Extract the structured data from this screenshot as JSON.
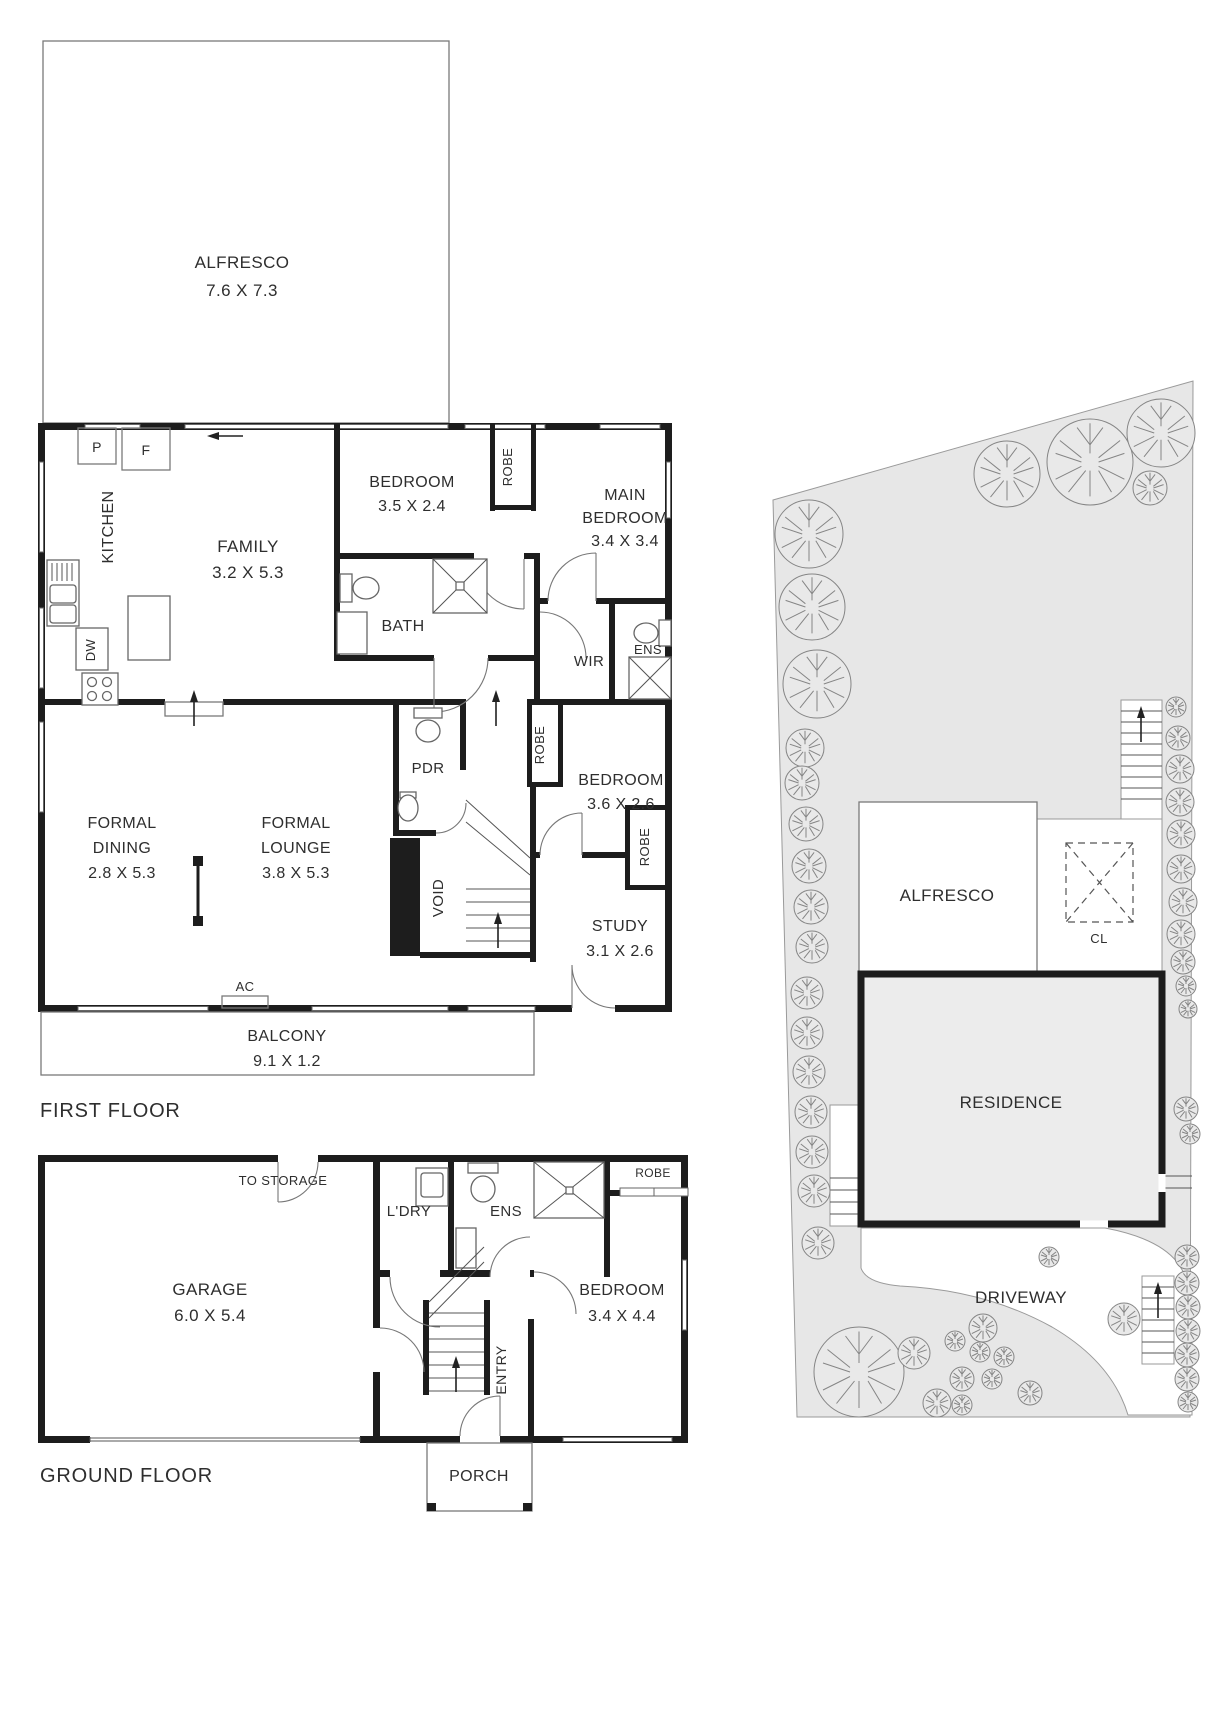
{
  "first_floor": {
    "section_label": "FIRST FLOOR",
    "alfresco": {
      "name": "ALFRESCO",
      "dims": "7.6 X 7.3"
    },
    "kitchen": {
      "name": "KITCHEN",
      "pantry_abbr": "P",
      "fridge_abbr": "F",
      "dishwasher_abbr": "DW"
    },
    "family": {
      "name": "FAMILY",
      "dims": "3.2 X 5.3"
    },
    "bedroom_2": {
      "name": "BEDROOM",
      "dims": "3.5 X 2.4"
    },
    "robe_bedroom_2": "ROBE",
    "main_bedroom": {
      "line1": "MAIN",
      "line2": "BEDROOM",
      "dims": "3.4 X 3.4"
    },
    "bath": "BATH",
    "wir": "WIR",
    "ens": "ENS",
    "pdr": "PDR",
    "bedroom_3": {
      "name": "BEDROOM",
      "dims": "3.6 X 2.6"
    },
    "robe_bedroom_3": "ROBE",
    "formal_dining": {
      "line1": "FORMAL",
      "line2": "DINING",
      "dims": "2.8 X 5.3"
    },
    "formal_lounge": {
      "line1": "FORMAL",
      "line2": "LOUNGE",
      "dims": "3.8 X 5.3"
    },
    "void": "VOID",
    "study": {
      "name": "STUDY",
      "dims": "3.1 X 2.6"
    },
    "robe_study": "ROBE",
    "ac": "AC",
    "balcony": {
      "name": "BALCONY",
      "dims": "9.1 X 1.2"
    }
  },
  "ground_floor": {
    "section_label": "GROUND FLOOR",
    "garage": {
      "name": "GARAGE",
      "dims": "6.0 X 5.4"
    },
    "to_storage": "TO STORAGE",
    "laundry": "L'DRY",
    "ens": "ENS",
    "robe": "ROBE",
    "bedroom": {
      "name": "BEDROOM",
      "dims": "3.4 X 4.4"
    },
    "entry": "ENTRY",
    "porch": "PORCH"
  },
  "site_plan": {
    "alfresco": "ALFRESCO",
    "clothesline": "CL",
    "residence": "RESIDENCE",
    "driveway": "DRIVEWAY"
  },
  "colors": {
    "wall": "#1d1d1d",
    "lot_fill": "#e7e7e7",
    "residence_fill": "#ececec",
    "text": "#2e2e2e",
    "line": "#666666"
  }
}
